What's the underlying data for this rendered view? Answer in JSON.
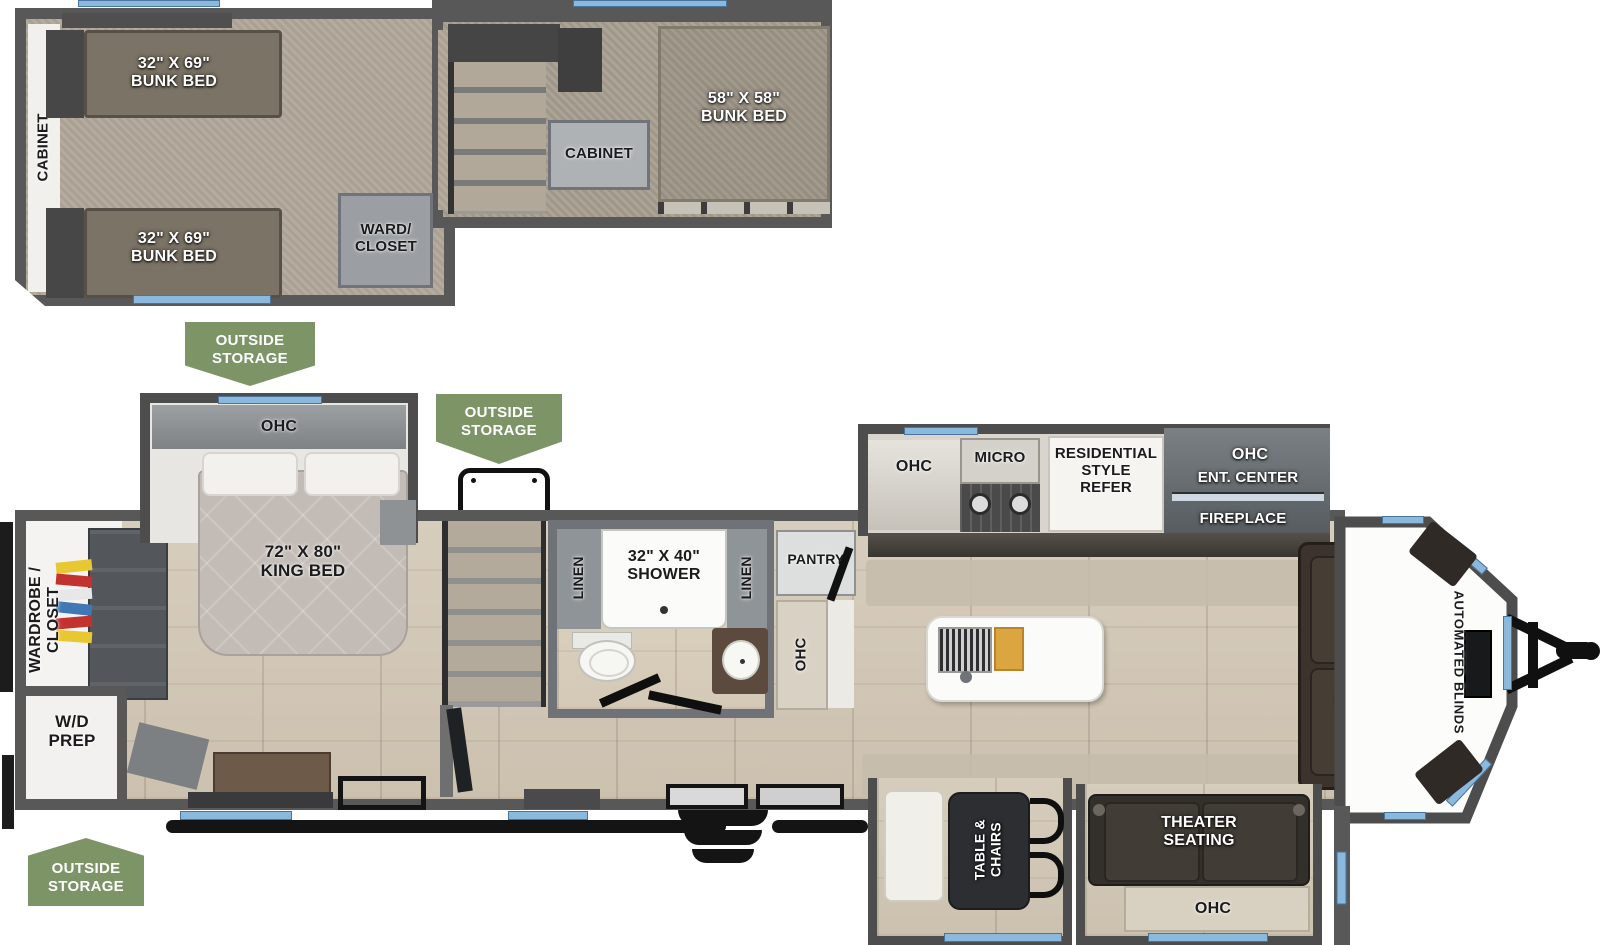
{
  "colors": {
    "badge_green": "#7d9467",
    "window_blue": "#8ab9dd",
    "wall_gray": "#585858",
    "wood_floor": "#d2c8b8",
    "carpet": "#b1a79a"
  },
  "badges": {
    "line1": "OUTSIDE",
    "line2": "STORAGE"
  },
  "upper": {
    "cabinet_wall": "CABINET",
    "bunk_top_l1": "32\" X 69\"",
    "bunk_top_l2": "BUNK BED",
    "bunk_bottom_l1": "32\" X 69\"",
    "bunk_bottom_l2": "BUNK BED",
    "ward_l1": "WARD/",
    "ward_l2": "CLOSET",
    "cabinet_box": "CABINET",
    "bunk_front_l1": "58\" X 58\"",
    "bunk_front_l2": "BUNK BED"
  },
  "bedroom": {
    "ohc": "OHC",
    "king_l1": "72\" X 80\"",
    "king_l2": "KING BED",
    "wardrobe_l1": "WARDROBE /",
    "wardrobe_l2": "CLOSET",
    "wd_l1": "W/D",
    "wd_l2": "PREP"
  },
  "bath": {
    "linen_left": "LINEN",
    "linen_right": "LINEN",
    "shower_l1": "32\" X 40\"",
    "shower_l2": "SHOWER",
    "pantry": "PANTRY",
    "ohc": "OHC"
  },
  "kitchen": {
    "ohc": "OHC",
    "micro": "MICRO",
    "refer_l1": "RESIDENTIAL",
    "refer_l2": "STYLE",
    "refer_l3": "REFER"
  },
  "ent": {
    "ohc": "OHC",
    "center": "ENT. CENTER",
    "fireplace": "FIREPLACE"
  },
  "living": {
    "sofa": "SOFA",
    "blinds": "AUTOMATED BLINDS"
  },
  "rear": {
    "table_l1": "TABLE &",
    "table_l2": "CHAIRS",
    "theater_l1": "THEATER",
    "theater_l2": "SEATING",
    "ohc": "OHC"
  }
}
